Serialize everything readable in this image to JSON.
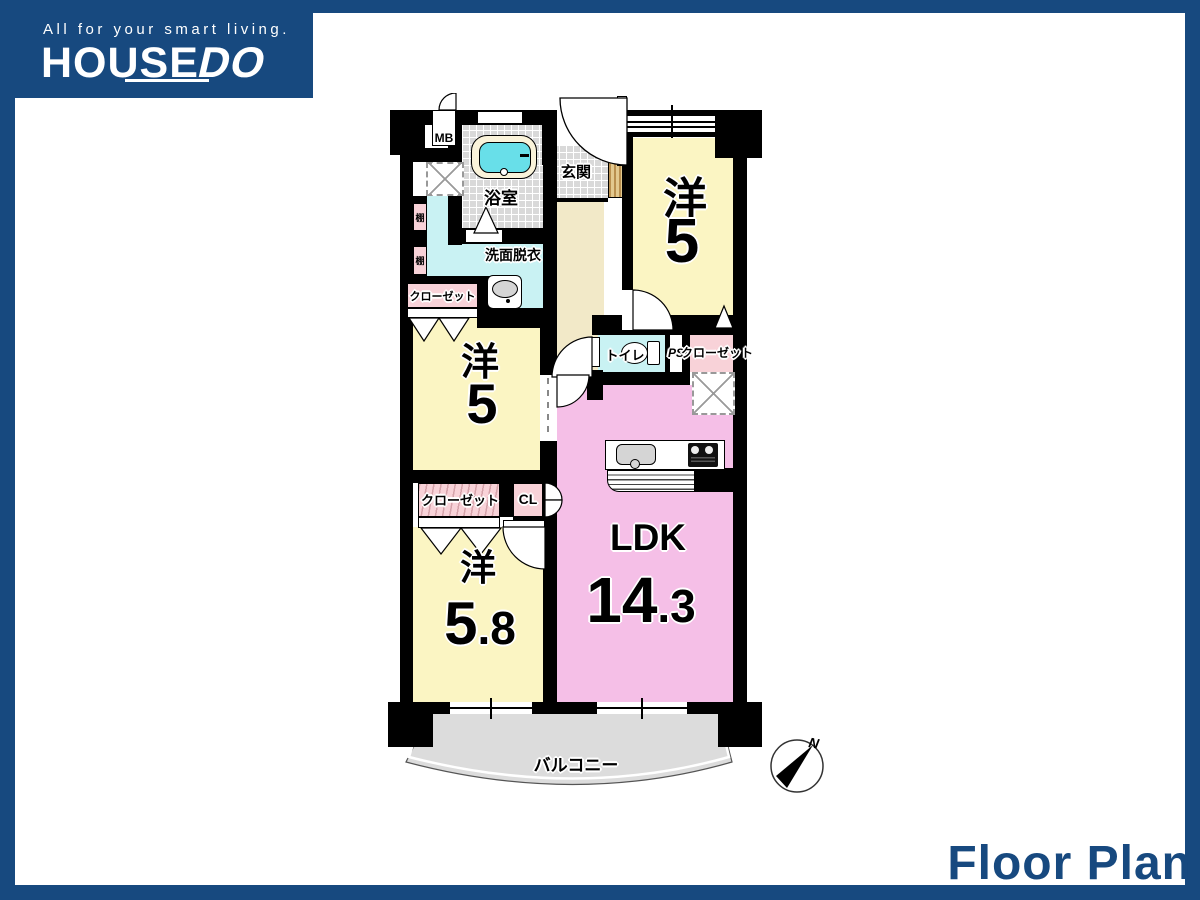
{
  "brand": {
    "tagline": "All for your smart living.",
    "name_main": "HOUSE",
    "name_accent": "DO"
  },
  "footer": {
    "title": "Floor Plan"
  },
  "colors": {
    "navy": "#17497F",
    "wall": "#000000",
    "room_yellow": "#FBF5C3",
    "ldk_pink": "#F5BFE7",
    "closet_pink": "#F8D2D8",
    "water_cyan": "#C9F2F3",
    "bathtub_cyan": "#68DFE9",
    "tile_gray": "#D9D9D9",
    "hall_beige": "#F2E9C8",
    "balcony_gray": "#DCDCDC"
  },
  "plan": {
    "labels": {
      "mb": "MB",
      "bathroom": "浴室",
      "entrance": "玄関",
      "washroom": "洗面脱衣",
      "shelf": "棚",
      "closet": "クローゼット",
      "toilet": "トイレ",
      "ps": "PS",
      "cl": "CL",
      "balcony": "バルコニー",
      "compass_north": "N"
    },
    "rooms": {
      "western_top": {
        "type": "洋",
        "size": "5"
      },
      "western_mid": {
        "type": "洋",
        "size": "5"
      },
      "western_bottom": {
        "type": "洋",
        "size_int": "5",
        "size_frac": ".8"
      },
      "ldk": {
        "name": "LDK",
        "size_int": "14",
        "size_frac": ".3"
      }
    }
  }
}
